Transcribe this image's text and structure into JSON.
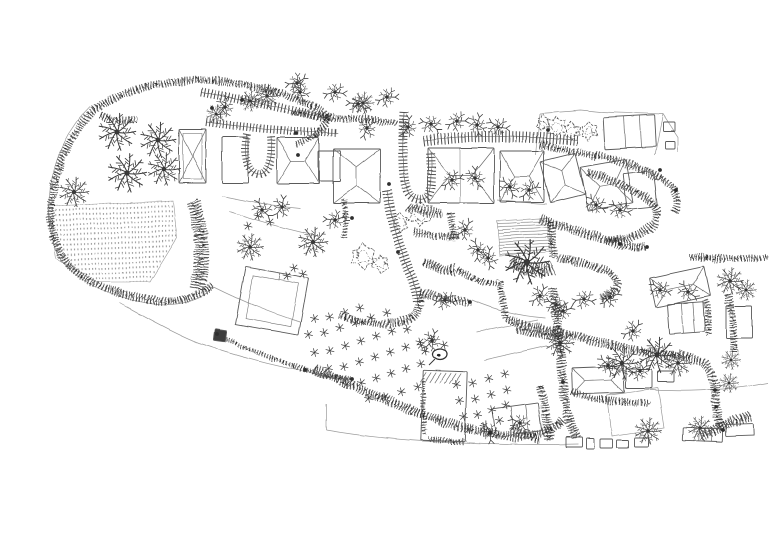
{
  "description": "Hand-drawn ink site plan of a village garden landscape with palm trees, hedges, buildings, orchard rows and a dotted crop field",
  "palette": {
    "ink": "#3a3a3a",
    "ink_dark": "#222222",
    "ink_mid": "#555555",
    "ink_light": "#8a8a8a",
    "faint": "#9a9a9a",
    "paper": "#ffffff"
  },
  "canvas": {
    "width": 770,
    "height": 544
  },
  "map": {
    "palms": [
      [
        117,
        132,
        1.25
      ],
      [
        158,
        140,
        1.2
      ],
      [
        127,
        173,
        1.3
      ],
      [
        164,
        169,
        1.1
      ],
      [
        74,
        192,
        1.0
      ],
      [
        250,
        101,
        0.7
      ],
      [
        267,
        96,
        0.8
      ],
      [
        216,
        114,
        0.65
      ],
      [
        363,
        103,
        0.75
      ],
      [
        250,
        247,
        0.9
      ],
      [
        313,
        242,
        1.0
      ],
      [
        527,
        262,
        1.5
      ],
      [
        560,
        343,
        0.95
      ],
      [
        622,
        363,
        1.1
      ],
      [
        657,
        355,
        1.2
      ],
      [
        678,
        363,
        0.9
      ],
      [
        648,
        431,
        0.9
      ],
      [
        700,
        428,
        0.8
      ],
      [
        730,
        281,
        0.9
      ],
      [
        746,
        290,
        0.7
      ],
      [
        731,
        360,
        0.65
      ],
      [
        729,
        383,
        0.65
      ]
    ],
    "twigs": [
      [
        300,
        92
      ],
      [
        335,
        92
      ],
      [
        358,
        104
      ],
      [
        367,
        128
      ],
      [
        387,
        97
      ],
      [
        408,
        127
      ],
      [
        431,
        124
      ],
      [
        457,
        121
      ],
      [
        477,
        125
      ],
      [
        498,
        127
      ],
      [
        452,
        180
      ],
      [
        475,
        178
      ],
      [
        510,
        187
      ],
      [
        529,
        190
      ],
      [
        335,
        220
      ],
      [
        282,
        207
      ],
      [
        262,
        210
      ],
      [
        465,
        230
      ],
      [
        478,
        250
      ],
      [
        488,
        258
      ],
      [
        445,
        300
      ],
      [
        540,
        296
      ],
      [
        556,
        305
      ],
      [
        584,
        299
      ],
      [
        563,
        311
      ],
      [
        610,
        297
      ],
      [
        633,
        331
      ],
      [
        608,
        365
      ],
      [
        640,
        371
      ],
      [
        490,
        432
      ],
      [
        520,
        423
      ],
      [
        225,
        107
      ],
      [
        297,
        83
      ],
      [
        596,
        205
      ],
      [
        620,
        210
      ],
      [
        660,
        290
      ],
      [
        688,
        292
      ],
      [
        432,
        341
      ]
    ],
    "fluffy": [
      [
        557,
        126,
        9
      ],
      [
        572,
        131,
        7
      ],
      [
        589,
        131,
        8
      ],
      [
        543,
        123,
        6
      ],
      [
        363,
        257,
        11
      ],
      [
        380,
        263,
        8
      ],
      [
        420,
        214,
        11
      ],
      [
        400,
        222,
        8
      ]
    ],
    "stars": [
      [
        420,
        342
      ],
      [
        432,
        339
      ],
      [
        444,
        345
      ],
      [
        425,
        351
      ],
      [
        294,
        268
      ],
      [
        303,
        274
      ],
      [
        287,
        276
      ],
      [
        270,
        222
      ],
      [
        258,
        216
      ],
      [
        248,
        226
      ]
    ],
    "orchard_rows": [
      [
        316,
        320,
        360,
        308,
        4
      ],
      [
        310,
        336,
        386,
        314,
        6
      ],
      [
        316,
        354,
        406,
        328,
        7
      ],
      [
        330,
        370,
        420,
        344,
        7
      ],
      [
        348,
        386,
        420,
        365,
        6
      ],
      [
        370,
        400,
        418,
        387,
        4
      ],
      [
        458,
        386,
        505,
        374,
        4
      ],
      [
        461,
        402,
        507,
        390,
        4
      ],
      [
        465,
        418,
        506,
        405,
        4
      ],
      [
        470,
        431,
        500,
        420,
        3
      ]
    ],
    "buildings": [
      {
        "x": 179,
        "y": 129,
        "w": 27,
        "h": 54,
        "rot": 0,
        "style": "cross"
      },
      {
        "x": 222,
        "y": 137,
        "w": 26,
        "h": 46,
        "rot": 0,
        "style": "plain"
      },
      {
        "x": 277,
        "y": 138,
        "w": 42,
        "h": 46,
        "rot": 0,
        "style": "hip-h"
      },
      {
        "x": 318,
        "y": 151,
        "w": 22,
        "h": 30,
        "rot": 0,
        "style": "plain"
      },
      {
        "x": 333,
        "y": 149,
        "w": 47,
        "h": 54,
        "rot": 0,
        "style": "hip-v"
      },
      {
        "x": 428,
        "y": 148,
        "w": 66,
        "h": 55,
        "rot": 0,
        "style": "hip-h"
      },
      {
        "x": 500,
        "y": 151,
        "w": 44,
        "h": 51,
        "rot": 0,
        "style": "hip-h"
      },
      {
        "x": 604,
        "y": 116,
        "w": 51,
        "h": 32,
        "rot": -3,
        "style": "plain"
      },
      {
        "x": 663,
        "y": 122,
        "w": 12,
        "h": 9,
        "rot": 0,
        "style": "plain"
      },
      {
        "x": 665,
        "y": 141,
        "w": 10,
        "h": 8,
        "rot": 0,
        "style": "plain"
      },
      {
        "x": 545,
        "y": 157,
        "w": 36,
        "h": 42,
        "rot": -14,
        "style": "hip-v"
      },
      {
        "x": 584,
        "y": 163,
        "w": 46,
        "h": 44,
        "rot": -10,
        "style": "hip-h"
      },
      {
        "x": 625,
        "y": 172,
        "w": 30,
        "h": 36,
        "rot": -6,
        "style": "plain"
      },
      {
        "x": 240,
        "y": 272,
        "w": 64,
        "h": 58,
        "rot": 10,
        "style": "court"
      },
      {
        "x": 214,
        "y": 330,
        "w": 12,
        "h": 11,
        "rot": 8,
        "style": "dark"
      },
      {
        "x": 422,
        "y": 371,
        "w": 44,
        "h": 70,
        "rot": 2,
        "style": "hatch-top"
      },
      {
        "x": 494,
        "y": 406,
        "w": 46,
        "h": 28,
        "rot": -8,
        "style": "plain"
      },
      {
        "x": 652,
        "y": 272,
        "w": 56,
        "h": 30,
        "rot": -12,
        "style": "hip-h"
      },
      {
        "x": 668,
        "y": 303,
        "w": 36,
        "h": 30,
        "rot": -4,
        "style": "plain"
      },
      {
        "x": 726,
        "y": 306,
        "w": 26,
        "h": 32,
        "rot": 0,
        "style": "plain"
      },
      {
        "x": 572,
        "y": 367,
        "w": 52,
        "h": 26,
        "rot": -2,
        "style": "hip-h"
      },
      {
        "x": 626,
        "y": 369,
        "w": 26,
        "h": 19,
        "rot": 0,
        "style": "plain"
      },
      {
        "x": 658,
        "y": 371,
        "w": 16,
        "h": 11,
        "rot": 0,
        "style": "plain"
      },
      {
        "x": 566,
        "y": 437,
        "w": 16,
        "h": 10,
        "rot": 0,
        "style": "plain"
      },
      {
        "x": 586,
        "y": 438,
        "w": 8,
        "h": 11,
        "rot": 0,
        "style": "plain"
      },
      {
        "x": 600,
        "y": 439,
        "w": 13,
        "h": 9,
        "rot": 0,
        "style": "plain"
      },
      {
        "x": 617,
        "y": 440,
        "w": 11,
        "h": 8,
        "rot": 0,
        "style": "plain"
      },
      {
        "x": 634,
        "y": 438,
        "w": 14,
        "h": 9,
        "rot": 0,
        "style": "plain"
      },
      {
        "x": 683,
        "y": 428,
        "w": 40,
        "h": 13,
        "rot": 2,
        "style": "plain"
      },
      {
        "x": 726,
        "y": 424,
        "w": 28,
        "h": 12,
        "rot": -2,
        "style": "plain"
      }
    ],
    "hedges": [
      {
        "d": "M94,110 C60,144 46,194 53,236 C62,272 100,291 150,300 C177,305 200,297 212,284",
        "w": 8
      },
      {
        "d": "M94,110 C138,80 200,74 250,86 C283,93 312,102 328,118",
        "w": 8
      },
      {
        "d": "M328,118 C323,131 310,140 296,145",
        "w": 7
      },
      {
        "d": "M194,202 C202,230 204,258 197,289",
        "w": 14
      },
      {
        "d": "M100,115 C112,120 124,122 136,120",
        "w": 6
      },
      {
        "d": "M293,112 C328,120 362,117 397,123",
        "w": 7
      },
      {
        "d": "M408,206 C420,212 433,214 443,213",
        "w": 9
      },
      {
        "d": "M414,231 C430,236 447,238 459,236",
        "w": 7
      },
      {
        "d": "M450,213 C452,222 453,232 452,241",
        "w": 7
      },
      {
        "d": "M344,200 C346,213 346,226 344,238",
        "w": 6
      },
      {
        "d": "M424,262 C436,268 447,271 456,270",
        "w": 10
      },
      {
        "d": "M512,262 C525,270 542,272 553,268",
        "w": 14
      },
      {
        "d": "M550,222 C552,235 553,247 553,258",
        "w": 8
      },
      {
        "d": "M558,258 C584,263 605,268 615,278 C620,287 614,296 600,299",
        "w": 8
      },
      {
        "d": "M596,155 C625,162 650,171 668,183 C678,191 680,203 674,213",
        "w": 8
      },
      {
        "d": "M588,172 C615,181 638,191 652,203 C659,211 659,221 649,229 C637,237 620,241 605,241",
        "w": 8
      },
      {
        "d": "M540,219 C568,229 596,237 622,244 C632,247 640,248 647,247",
        "w": 9
      },
      {
        "d": "M540,145 C560,149 578,153 596,157",
        "w": 7
      },
      {
        "d": "M420,293 C438,298 455,301 470,302",
        "w": 8
      },
      {
        "d": "M500,281 C502,295 504,308 506,318",
        "w": 7
      },
      {
        "d": "M517,329 C532,334 547,336 559,336",
        "w": 7
      },
      {
        "d": "M553,288 C557,318 560,350 563,382 C565,408 570,425 577,438",
        "w": 9
      },
      {
        "d": "M540,386 C545,404 548,422 549,440",
        "w": 8
      },
      {
        "d": "M506,319 C530,327 556,332 580,337 C618,348 650,354 688,357 C706,360 714,372 715,390 C716,408 718,421 723,430",
        "w": 9
      },
      {
        "d": "M340,316 C364,323 388,327 408,320 C418,315 421,304 420,295",
        "w": 8
      },
      {
        "d": "M315,369 C345,383 376,396 408,409 C442,423 477,432 510,436 C534,438 554,430 564,419",
        "w": 9
      },
      {
        "d": "M216,334 C245,348 274,360 304,369 C324,376 340,379 352,379",
        "w": 5
      },
      {
        "d": "M690,257 C715,259 744,259 768,257",
        "w": 7
      },
      {
        "d": "M727,294 C733,314 735,333 734,353",
        "w": 7
      },
      {
        "d": "M702,436 C718,428 734,421 750,416",
        "w": 10
      },
      {
        "d": "M572,392 C595,399 620,403 648,403",
        "w": 7
      },
      {
        "d": "M705,300 C708,312 709,324 708,336",
        "w": 7
      },
      {
        "d": "M424,380 C423,398 423,416 425,434",
        "w": 4
      },
      {
        "d": "M430,438 C442,442 455,443 465,441",
        "w": 6
      },
      {
        "d": "M512,428 C522,434 532,438 540,441",
        "w": 8
      },
      {
        "d": "M458,270 C470,278 484,283 498,284",
        "w": 6
      }
    ],
    "fences": [
      {
        "d": "M201,92 C245,100 290,109 329,119",
        "w": 9
      },
      {
        "d": "M206,122 C250,128 295,132 338,133",
        "w": 8
      },
      {
        "d": "M247,134 C243,155 247,172 258,174 C269,175 273,158 271,136",
        "w": 8
      },
      {
        "d": "M424,141 C475,134 530,136 578,141",
        "w": 11
      },
      {
        "d": "M387,190 C391,218 399,246 409,270 C414,282 417,292 418,303",
        "w": 10
      },
      {
        "d": "M404,112 C402,150 402,176 407,190 C411,200 423,202 428,196 C432,190 432,168 431,152",
        "w": 9
      }
    ],
    "plots": [
      "M90,106 C56,140 43,192 51,236 C60,274 98,295 150,303 C178,308 202,300 214,287",
      "M120,303 C152,321 180,336 199,343 C235,355 272,365 306,371",
      "M214,287 C240,300 268,312 300,322",
      "M306,371 C320,376 336,379 352,379",
      "M222,196 L262,204 L300,208",
      "M230,212 C260,222 290,230 318,236",
      "M540,113 L580,110 L600,112 L663,114 L678,137 L678,152",
      "M663,114 L655,155",
      "M540,113 L536,155",
      "M430,203 L494,203 M460,148 L460,203",
      "M472,300 C495,310 520,316 545,318",
      "M477,332 L538,320",
      "M484,360 L546,346",
      "M607,395 L658,388 L664,428 L612,436 L607,395",
      "M650,390 C690,392 730,390 768,383",
      "M326,430 C360,436 400,440 440,442 C490,445 540,445 578,444",
      "M326,404 L326,430",
      "M497,200 C514,202 531,203 547,204"
    ],
    "fields": [
      {
        "d": "M48,206 L173,201 L177,238 L150,282 L95,282 L56,258 Z",
        "pattern": "dots"
      },
      {
        "d": "M497,221 L548,218 L552,251 L500,256 Z",
        "pattern": "lines"
      }
    ],
    "dots": [
      [
        296,
        133
      ],
      [
        298,
        155
      ],
      [
        389,
        184
      ],
      [
        352,
        379
      ],
      [
        305,
        370
      ],
      [
        217,
        334
      ],
      [
        470,
        302
      ],
      [
        620,
        244
      ],
      [
        647,
        247
      ],
      [
        715,
        390
      ],
      [
        723,
        430
      ],
      [
        563,
        382
      ],
      [
        490,
        433
      ],
      [
        242,
        100
      ],
      [
        212,
        108
      ],
      [
        548,
        130
      ],
      [
        352,
        218
      ],
      [
        398,
        252
      ],
      [
        660,
        170
      ],
      [
        676,
        190
      ]
    ],
    "landmark": {
      "cx": 440,
      "cy": 354,
      "rx": 7,
      "ry": 5.5
    }
  }
}
